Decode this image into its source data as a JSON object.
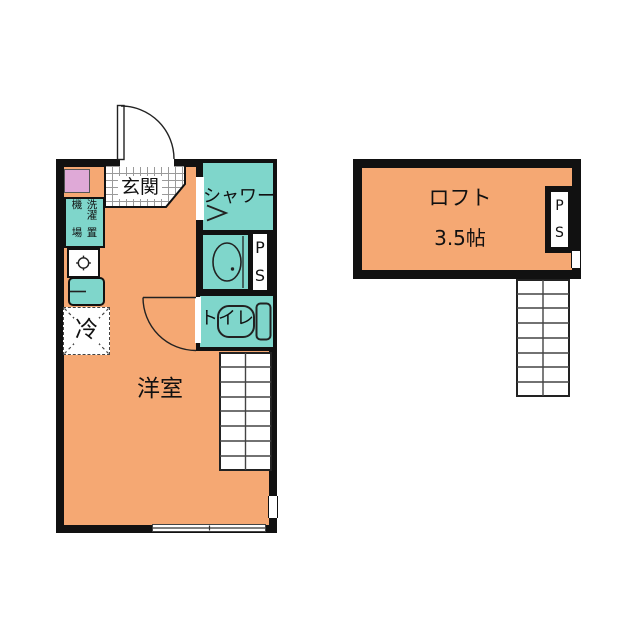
{
  "colors": {
    "room_orange": "#F5A873",
    "fixture_teal": "#7FD6CB",
    "closet_pink": "#DFA9D7",
    "wall_black": "#111111"
  },
  "floor1": {
    "entrance": "玄関",
    "shower": "シャワー",
    "toilet": "トイレ",
    "room": "洋室",
    "fridge": "冷",
    "washer_col_right": "洗濯機",
    "washer_col_left": "置場",
    "ps_top": "P",
    "ps_bottom": "S"
  },
  "loft": {
    "name": "ロフト",
    "size": "3.5帖",
    "ps_top": "P",
    "ps_bottom": "S"
  }
}
